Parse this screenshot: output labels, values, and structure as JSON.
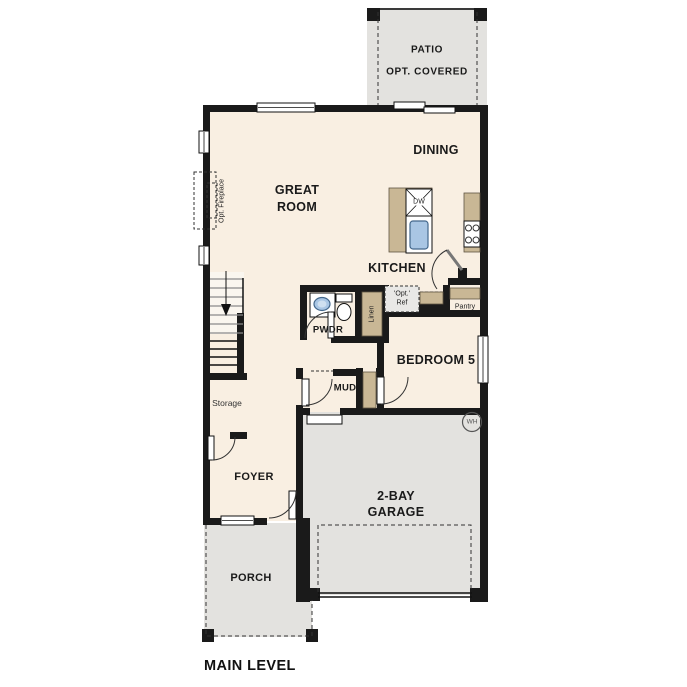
{
  "plan": {
    "caption": "MAIN LEVEL",
    "rooms": {
      "patio": {
        "line1": "PATIO",
        "line2": "OPT. COVERED"
      },
      "dining": "DINING",
      "great_room": {
        "line1": "GREAT",
        "line2": "ROOM"
      },
      "kitchen": "KITCHEN",
      "powder": "PWDR",
      "linen": "Linen",
      "opt_ref": {
        "line1": "'Opt.'",
        "line2": "Ref"
      },
      "pantry": "Pantry",
      "bedroom5": "BEDROOM 5",
      "mud": "MUD",
      "storage": "Storage",
      "foyer": "FOYER",
      "garage": {
        "line1": "2-BAY",
        "line2": "GARAGE"
      },
      "porch": "PORCH",
      "opt_fireplace": "Opt. Fireplace"
    },
    "appliances": {
      "dishwasher": "DW",
      "water_heater": "WH"
    },
    "colors": {
      "floor": "#f9efe2",
      "exterior": "#e3e2df",
      "counter": "#c9b795",
      "wall": "#1a1a1a",
      "sink": "#a9c6e4",
      "optional": "#e9e8e6"
    }
  }
}
